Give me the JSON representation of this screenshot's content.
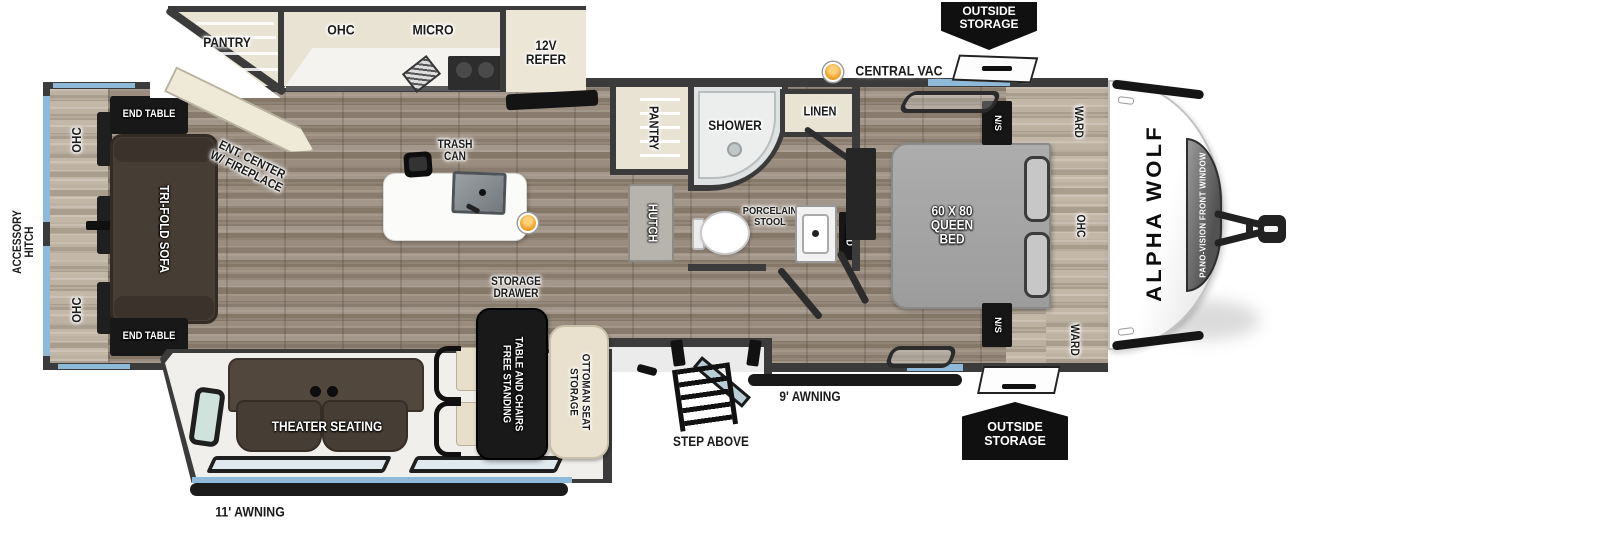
{
  "title": "Alpha Wolf travel trailer floor plan",
  "colors": {
    "wall": "#3b3b3b",
    "window_blue": "#8fb9d9",
    "badge_black": "#101010",
    "accent_orange": "#f2a32a"
  },
  "exterior": {
    "accessory_hitch": {
      "lines": [
        "ACCESSORY",
        "HITCH"
      ]
    },
    "central_vac": "CENTRAL VAC",
    "outside_storage_top": {
      "lines": [
        "OUTSIDE",
        "STORAGE"
      ]
    },
    "outside_storage_bottom": {
      "lines": [
        "OUTSIDE",
        "STORAGE"
      ]
    },
    "awning_rear": "11' AWNING",
    "awning_front": "9' AWNING",
    "step_above": "STEP ABOVE",
    "brand": "ALPHA WOLF",
    "front_window": "PANO-VISION FRONT WINDOW"
  },
  "living": {
    "ohc_top": "OHC",
    "ohc_bottom": "OHC",
    "end_table_top": "END TABLE",
    "end_table_bottom": "END TABLE",
    "sofa": "TRI-FOLD SOFA",
    "ent_center": {
      "lines": [
        "ENT. CENTER",
        "W/ FIREPLACE"
      ]
    },
    "theater": "THEATER SEATING"
  },
  "kitchen": {
    "pantry": "PANTRY",
    "ohc": "OHC",
    "micro": "MICRO",
    "refer": {
      "lines": [
        "12V",
        "REFER"
      ]
    },
    "trash": {
      "lines": [
        "TRASH",
        "CAN"
      ]
    },
    "island_storage": {
      "lines": [
        "STORAGE",
        "DRAWER"
      ]
    }
  },
  "dinette": {
    "table": {
      "lines": [
        "FREE STANDING",
        "TABLE AND CHAIRS"
      ]
    },
    "ottoman": {
      "lines": [
        "STORAGE",
        "OTTOMAN SEAT"
      ]
    }
  },
  "bath": {
    "pantry": "PANTRY",
    "hutch": "HUTCH",
    "shower": "SHOWER",
    "linen": "LINEN",
    "toilet": {
      "lines": [
        "PORCELAIN",
        "STOOL"
      ]
    },
    "med": "MED"
  },
  "bedroom": {
    "bed": {
      "lines": [
        "60 X 80",
        "QUEEN",
        "BED"
      ]
    },
    "ns_top": "N/S",
    "ns_bottom": "N/S",
    "ward_top": "WARD",
    "ward_bottom": "WARD",
    "ohc": "OHC"
  }
}
